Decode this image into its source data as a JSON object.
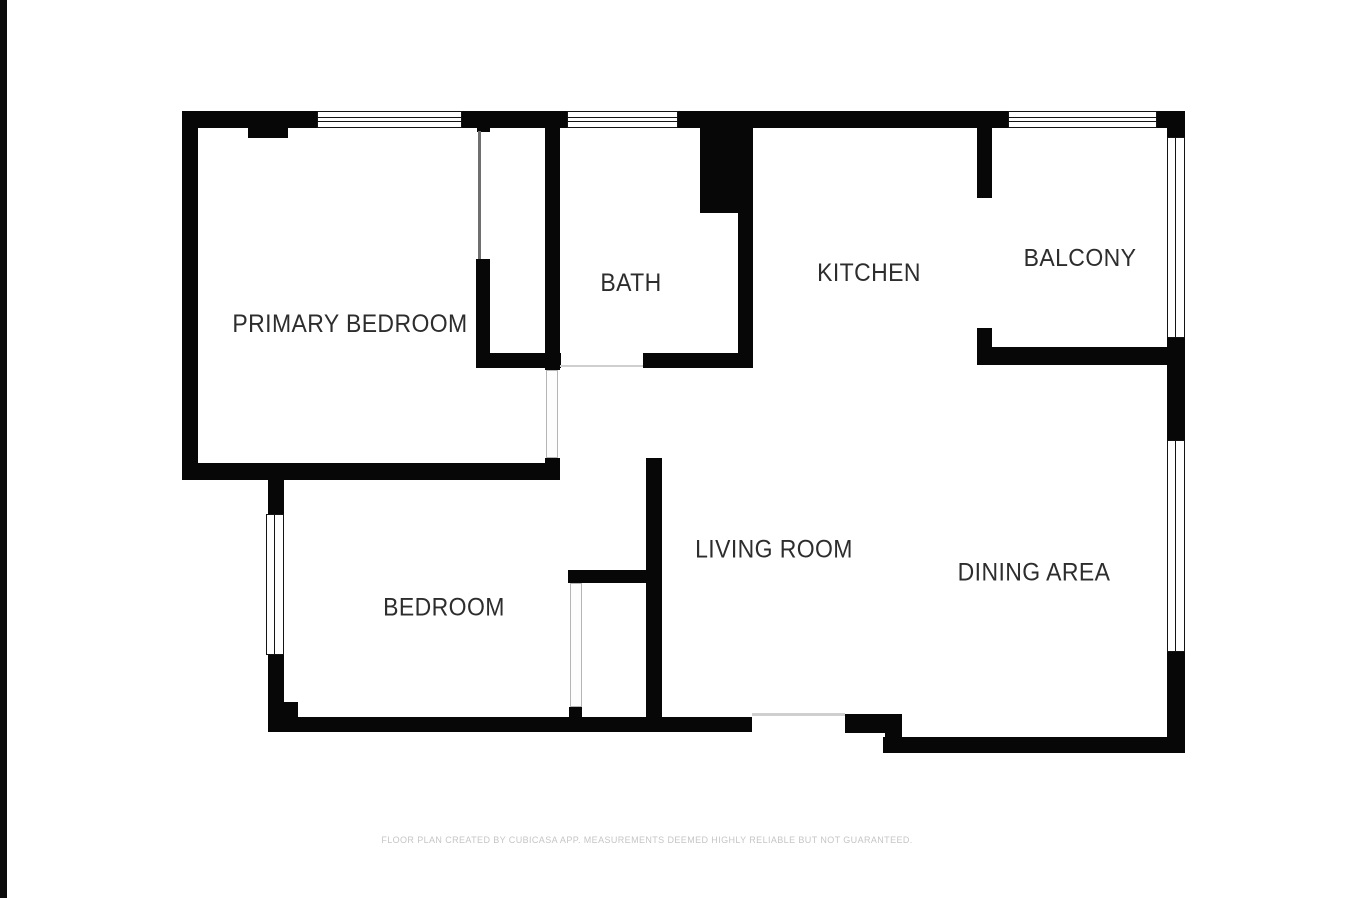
{
  "floor_plan": {
    "rooms": [
      {
        "label": "PRIMARY BEDROOM"
      },
      {
        "label": "BATH"
      },
      {
        "label": "KITCHEN"
      },
      {
        "label": "BALCONY"
      },
      {
        "label": "LIVING ROOM"
      },
      {
        "label": "DINING AREA"
      },
      {
        "label": "BEDROOM"
      }
    ],
    "footer": "FLOOR PLAN CREATED BY CUBICASA APP. MEASUREMENTS DEEMED HIGHLY RELIABLE BUT NOT GUARANTEED.",
    "colors": {
      "wall": "#070707",
      "label_text": "#2d2d2d",
      "footer_text": "#c5c5c5",
      "background": "#ffffff"
    }
  }
}
